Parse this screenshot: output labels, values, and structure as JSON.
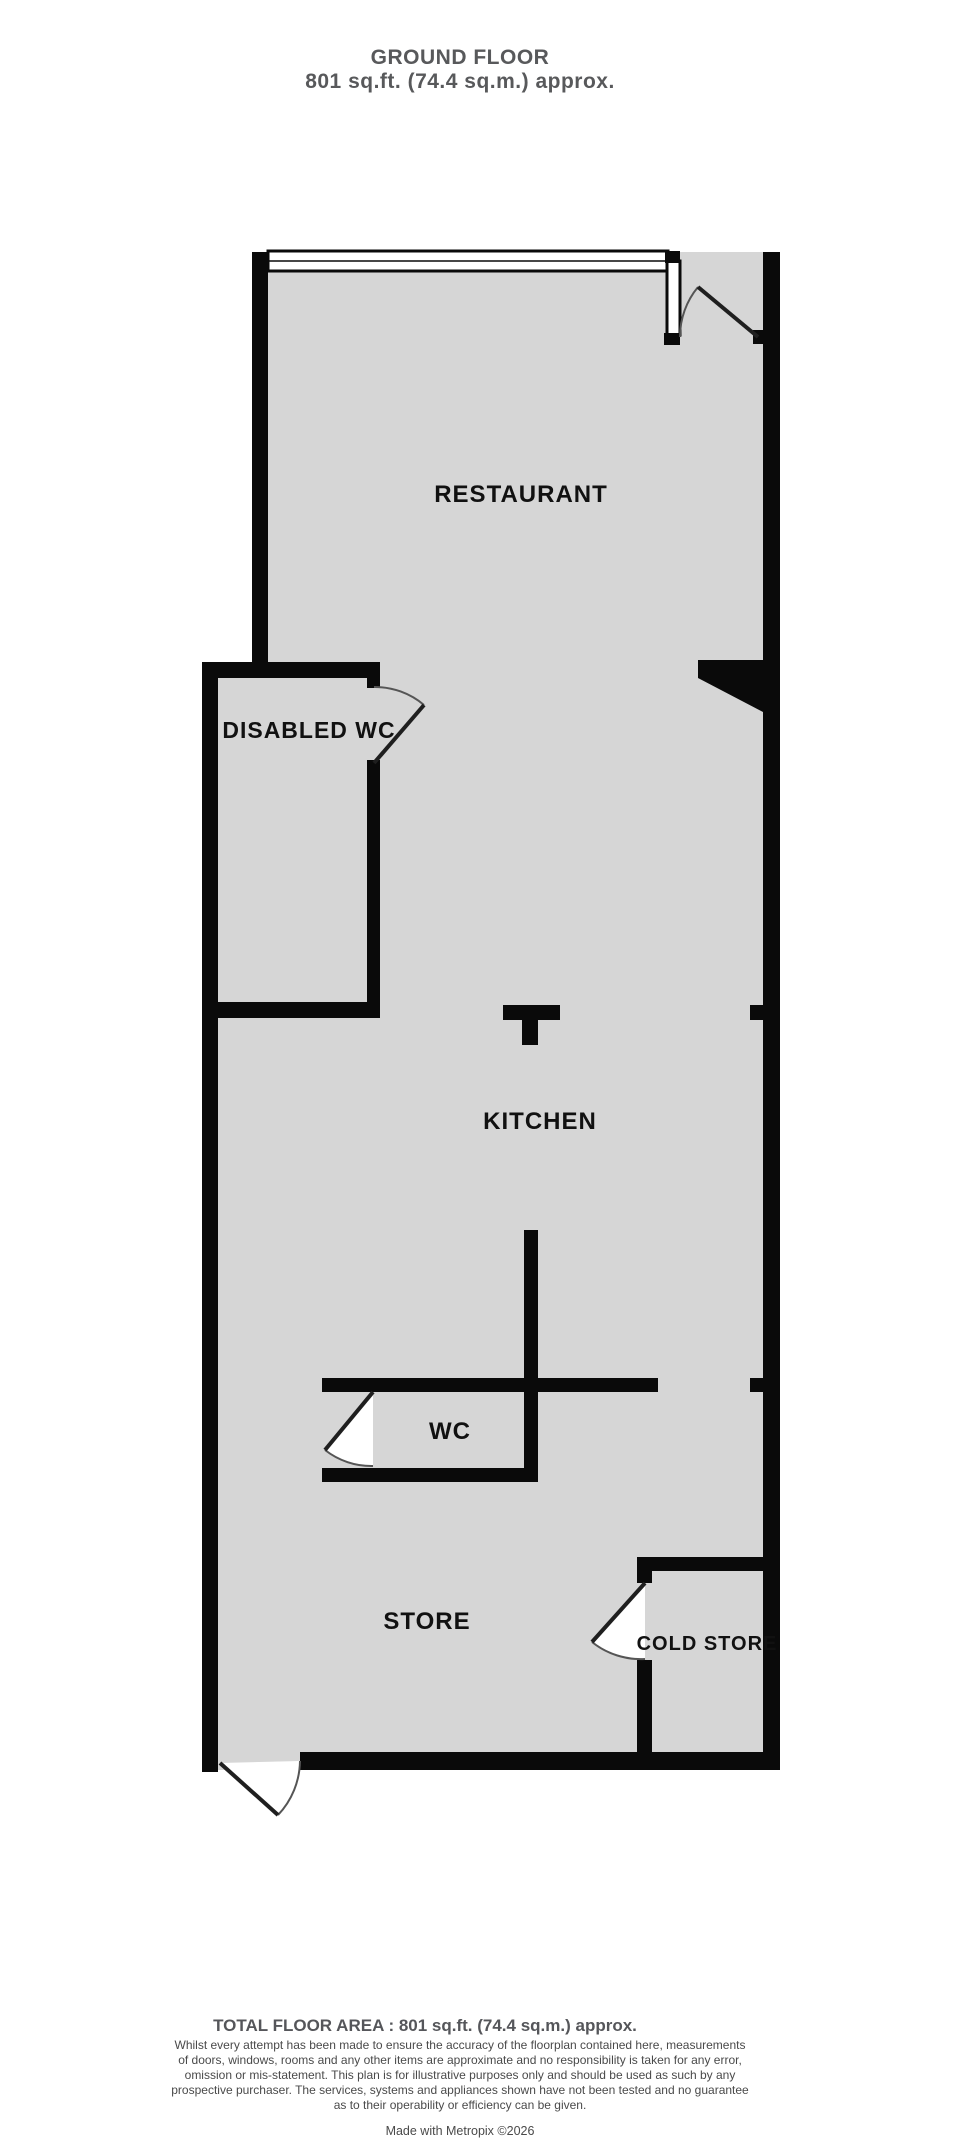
{
  "header": {
    "title": "GROUND FLOOR",
    "subtitle": "801 sq.ft. (74.4 sq.m.) approx."
  },
  "rooms": {
    "restaurant": {
      "label": "RESTAURANT"
    },
    "disabled_wc": {
      "label": "DISABLED WC"
    },
    "kitchen": {
      "label": "KITCHEN"
    },
    "wc": {
      "label": "WC"
    },
    "store": {
      "label": "STORE"
    },
    "cold_store": {
      "label": "COLD STORE"
    }
  },
  "footer": {
    "total_area": "TOTAL FLOOR AREA : 801 sq.ft. (74.4 sq.m.) approx.",
    "disclaimer_lines": [
      "Whilst every attempt has been made to ensure the accuracy of the floorplan contained here, measurements",
      "of doors, windows, rooms and any other items are approximate and no responsibility is taken for any error,",
      "omission or mis-statement. This plan is for illustrative purposes only and should be used as such by any",
      "prospective purchaser. The services, systems and appliances shown have not been tested and no guarantee",
      "as to their operability or efficiency can be given."
    ],
    "credit": "Made with Metropix ©2026"
  },
  "colors": {
    "floor_fill": "#d6d6d6",
    "wall": "#0a0a0a",
    "heading_text": "#58595b",
    "label_text": "#111111",
    "disclaimer_text": "#4a4a4a"
  }
}
